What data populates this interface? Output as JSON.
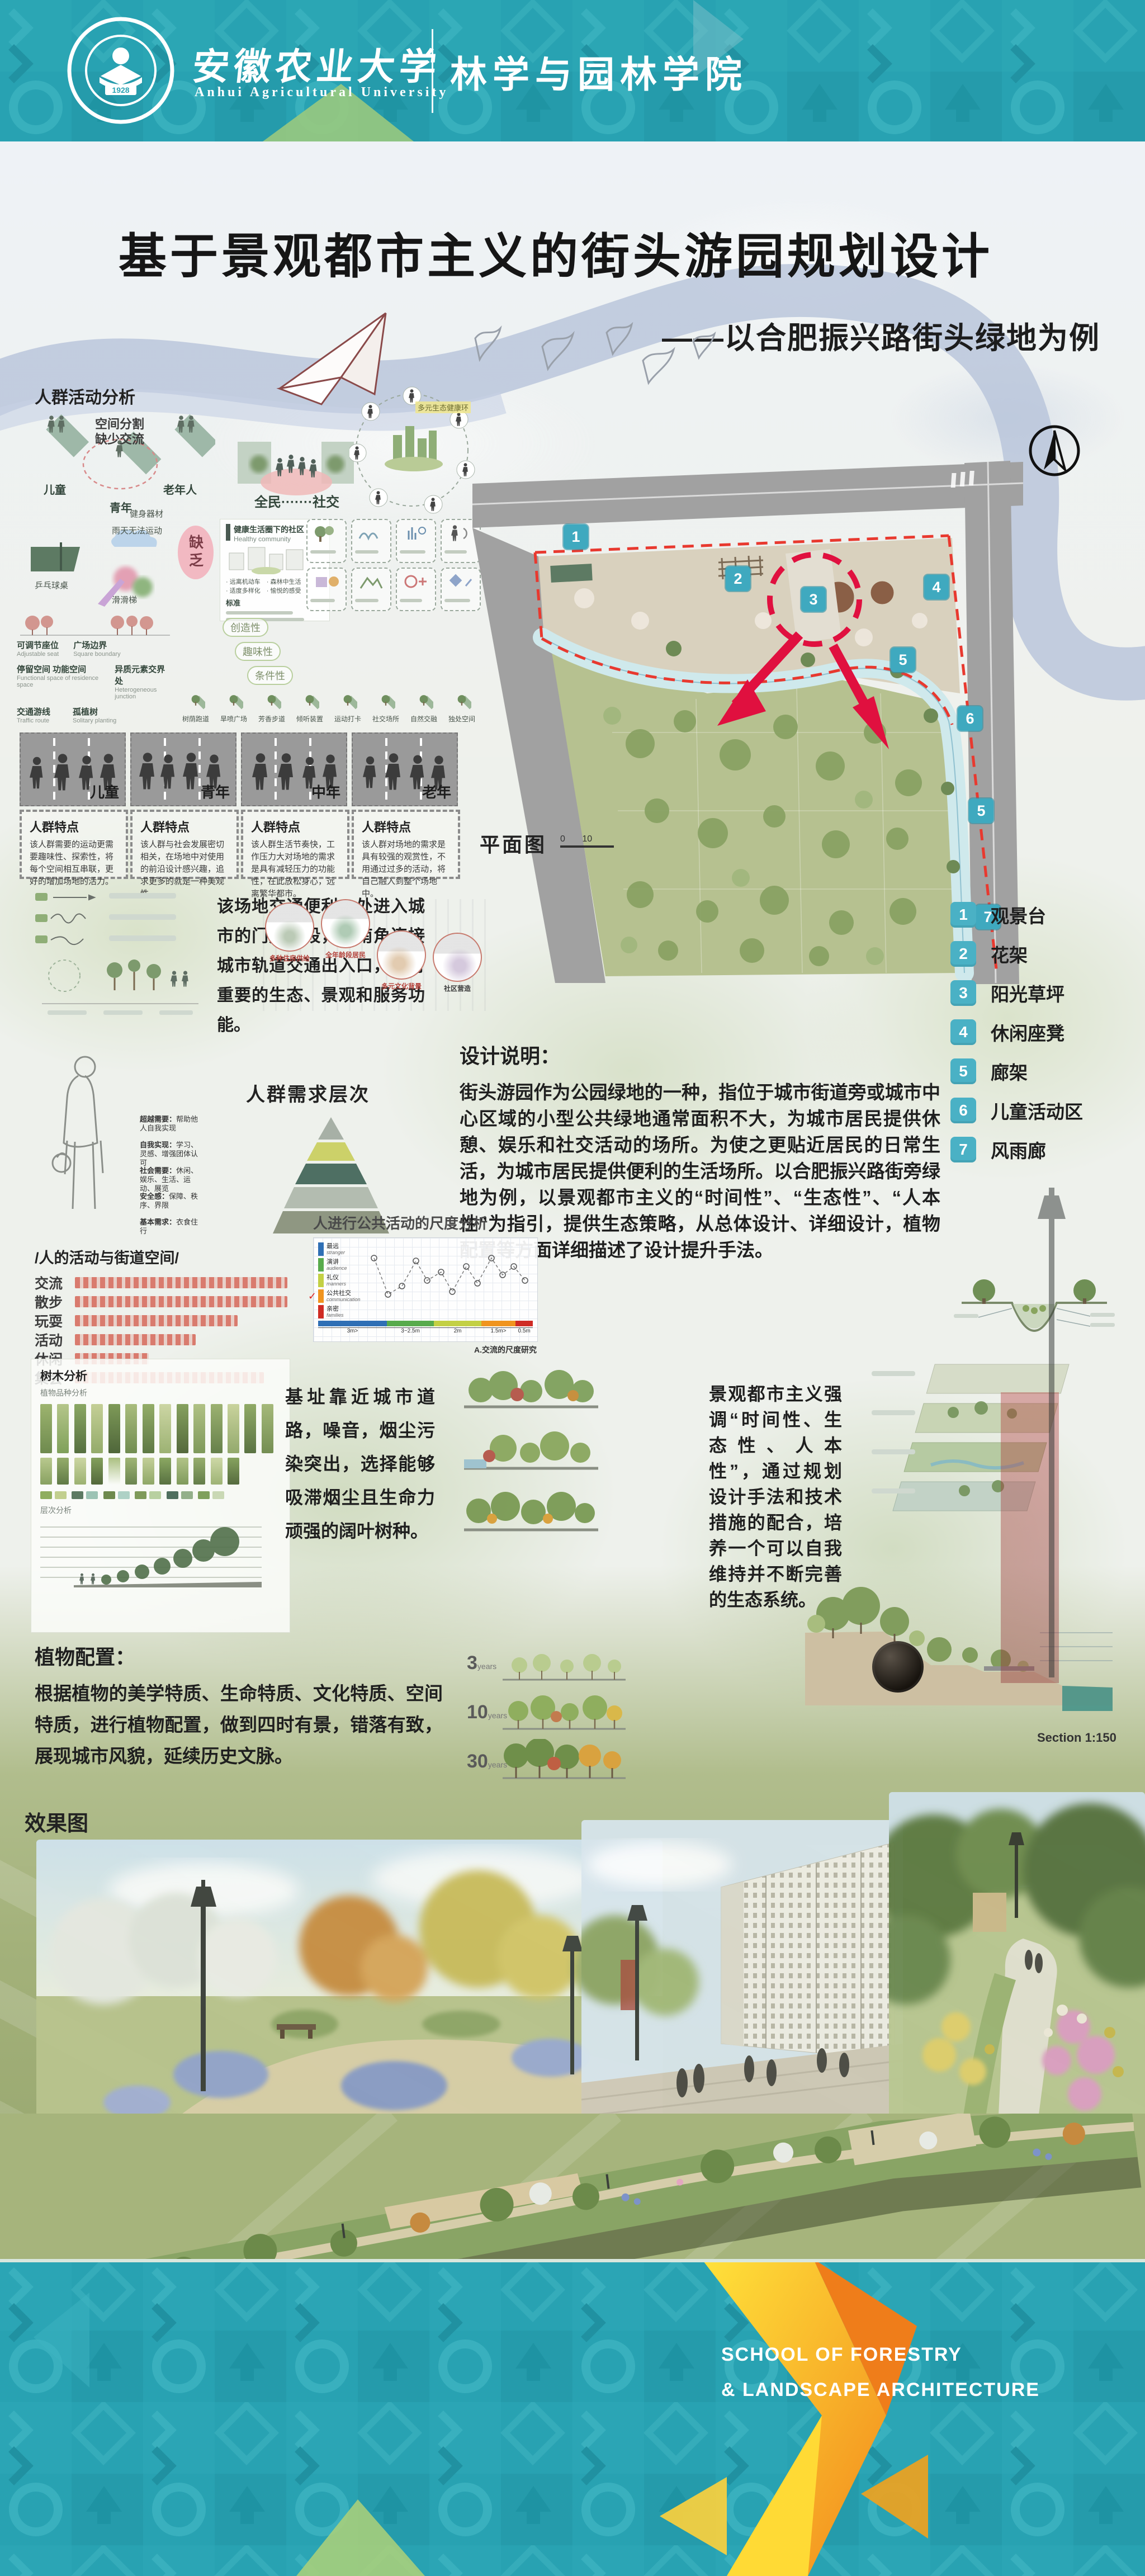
{
  "colors": {
    "teal": "#2aa4b4",
    "legend_chip": "#4ab1c5",
    "boundary_red": "#e8392f",
    "arrow_red": "#e0103f",
    "accent_green": "#aed178",
    "arrow_yellow": "#ffd83d",
    "arrow_orange": "#f2891c"
  },
  "header": {
    "university_cn": "安徽农业大学",
    "university_en": "Anhui Agricultural University",
    "school_cn": "林学与园林学院",
    "logo_year": "1928"
  },
  "title": {
    "main": "基于景观都市主义的街头游园规划设计",
    "subtitle": "——以合肥振兴路街头绿地为例"
  },
  "activity_analysis": {
    "label": "人群活动分析",
    "platform_groups": [
      "儿童",
      "青年",
      "老年人"
    ],
    "callout_line1": "空间分割",
    "callout_line2": "缺少交流",
    "social": "全民·······社交",
    "equipment": [
      "乒乓球桌",
      "雨天无法运动",
      "健身器材",
      "滑滑梯"
    ],
    "lack": "缺乏",
    "pills": [
      "创造性",
      "趣味性",
      "条件性"
    ],
    "healthy": {
      "title_cn": "健康生活圈下的社区",
      "title_en": "Healthy community",
      "standard": "标准",
      "bullets": [
        "远离机动车",
        "森林中生活",
        "适度多样化",
        "愉悦的感受"
      ]
    },
    "eco_label": "多元生态健康环",
    "sketches": [
      {
        "cn": "可调节座位",
        "en": "Adjustable seat"
      },
      {
        "cn": "广场边界",
        "en": "Square boundary"
      },
      {
        "cn": "停留空间 功能空间",
        "en": "Functional space of residence space"
      },
      {
        "cn": "异质元素交界处",
        "en": "Heterogeneous junction"
      },
      {
        "cn": "交通游线",
        "en": "Traffic route"
      },
      {
        "cn": "孤植树",
        "en": "Solitary planting"
      }
    ],
    "iso_items": [
      "树荫跑道",
      "旱喷广场",
      "芳香步道",
      "倾听装置",
      "运动打卡",
      "社交场所",
      "自然交融",
      "独处空间"
    ]
  },
  "age_groups": {
    "feature_title": "人群特点",
    "panels": [
      {
        "label": "儿童",
        "desc": "该人群需要的运动更需要趣味性、探索性，将每个空间相互串联，更好的增加场地的活力。"
      },
      {
        "label": "青年",
        "desc": "该人群与社会发展密切相关，在场地中对使用的前沿设计感兴趣，追求更多的就是一种美观性。"
      },
      {
        "label": "中年",
        "desc": "该人群生活节奏快，工作压力大对场地的需求是具有减轻压力的功能性，在此放松身心，远离繁华都市。"
      },
      {
        "label": "老年",
        "desc": "该人群对场地的需求是具有较强的观赏性，不用通过过多的活动，将自己融入到整个场地中。"
      }
    ]
  },
  "site_text": "该场地交通便利，处进入城市的门户地段，东南角连接城市轨道交通出入口，具有重要的生态、景观和服务功能。",
  "plan": {
    "label": "平面图",
    "scale_ticks": [
      "0",
      "10"
    ],
    "markers": [
      "1",
      "2",
      "3",
      "4",
      "5",
      "6",
      "5",
      "7"
    ]
  },
  "needs_pyramid": {
    "title": "人群需求层次",
    "levels": [
      {
        "name": "超越需要：",
        "desc": "帮助他人自我实现"
      },
      {
        "name": "自我实现：",
        "desc": "学习、灵感、增强团体认可"
      },
      {
        "name": "社会需要：",
        "desc": "休闲、娱乐、生活、运动、展览"
      },
      {
        "name": "安全感：",
        "desc": "保障、秩序、界限"
      },
      {
        "name": "基本需求：",
        "desc": "衣食住行"
      }
    ]
  },
  "city_circles": [
    "多种住房供给",
    "全年龄段居民",
    "多元文化背景",
    "社区营造"
  ],
  "design_note": {
    "title": "设计说明：",
    "body": "街头游园作为公园绿地的一种，指位于城市街道旁或城市中心区域的小型公共绿地通常面积不大，为城市居民提供休憩、娱乐和社交活动的场所。为使之更贴近居民的日常生活，为城市居民提供便利的生活场所。以合肥振兴路街旁绿地为例，以景观都市主义的“时间性”、“生态性”、“人本性”为指引，提供生态策略，从总体设计、详细设计，植物配置等方面详细描述了设计提升手法。"
  },
  "legend": [
    {
      "num": "1",
      "label": "观景台"
    },
    {
      "num": "2",
      "label": "花架"
    },
    {
      "num": "3",
      "label": "阳光草坪"
    },
    {
      "num": "4",
      "label": "休闲座凳"
    },
    {
      "num": "5",
      "label": "廊架"
    },
    {
      "num": "6",
      "label": "儿童活动区"
    },
    {
      "num": "7",
      "label": "风雨廊"
    }
  ],
  "street_activity": {
    "title": "/人的活动与街道空间/",
    "rows": [
      {
        "label": "交流",
        "pct": 88
      },
      {
        "label": "散步",
        "pct": 96
      },
      {
        "label": "玩耍",
        "pct": 62
      },
      {
        "label": "活动",
        "pct": 46
      },
      {
        "label": "休闲",
        "pct": 28
      },
      {
        "label": "集会",
        "pct": 72
      }
    ]
  },
  "scale_chart": {
    "title": "人进行公共活动的尺度分析",
    "legend": [
      {
        "cn": "最远",
        "en": "stranger",
        "color": "#2f6fb5"
      },
      {
        "cn": "演讲",
        "en": "audience",
        "color": "#58ab4c"
      },
      {
        "cn": "礼仪",
        "en": "manners",
        "color": "#c3d044"
      },
      {
        "cn": "公共社交",
        "en": "communication",
        "color": "#f0941f"
      },
      {
        "cn": "亲密",
        "en": "families",
        "color": "#cf2b24"
      }
    ],
    "distances": [
      "3m>",
      "3~2.5m",
      "2m",
      "1.5m>",
      "0.5m"
    ],
    "footnote": "A.交流的尺度研究"
  },
  "plant_panel": {
    "title": "树木分析",
    "sub1": "植物品种分析",
    "sub2": "层次分析"
  },
  "base_text": "基址靠近城市道路，噪音，烟尘污染突出，选择能够吸滞烟尘且生命力顽强的阔叶树种。",
  "plant_config": {
    "title": "植物配置：",
    "body": "根据植物的美学特质、生命特质、文化特质、空间特质，进行植物配置，做到四时有景，错落有致，展现城市风貌，延续历史文脉。"
  },
  "urbanism_text": "景观都市主义强调“时间性、生态性、人本性”，通过规划设计手法和技术措施的配合，培养一个可以自我维持并不断完善的生态系统。",
  "growth_stages": [
    {
      "num": "3",
      "unit_cn": "年",
      "unit_en": "years"
    },
    {
      "num": "10",
      "unit_cn": "年",
      "unit_en": "years"
    },
    {
      "num": "30",
      "unit_cn": "年",
      "unit_en": "years"
    }
  ],
  "section_label": "Section 1:150",
  "renderings_label": "效果图",
  "aerial_label": "鸟瞰图",
  "credits": "姓名：陈惠惠学号：20113604   班级专业：2020级园林（1）班  指导老师：王嘉楠",
  "footer": {
    "line1": "SCHOOL OF FORESTRY",
    "line2": "& LANDSCAPE ARCHITECTURE"
  }
}
